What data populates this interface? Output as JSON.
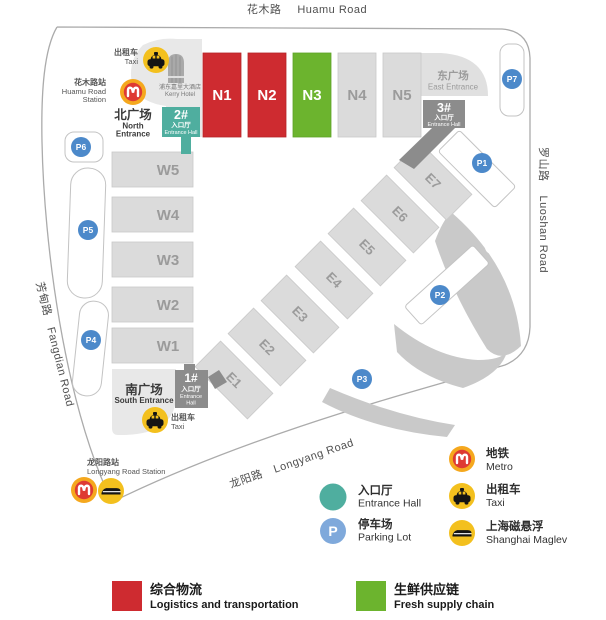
{
  "map": {
    "roads": {
      "huamu": {
        "cn": "花木路",
        "en": "Huamu Road"
      },
      "luoshan": {
        "cn": "罗山路",
        "en": "Luoshan Road"
      },
      "fangdian": {
        "cn": "芳甸路",
        "en": "Fangdian Road"
      },
      "longyang": {
        "cn": "龙阳路",
        "en": "Longyang Road"
      }
    },
    "stations": {
      "huamu": {
        "cn": "花木路站",
        "en1": "Huamu Road",
        "en2": "Station"
      },
      "longyang": {
        "cn": "龙阳路站",
        "en": "Longyang Road Station"
      }
    },
    "hotel": {
      "cn": "浦东嘉里大酒店",
      "en": "Kerry Hotel"
    },
    "plazas": {
      "north": {
        "cn": "北广场",
        "en1": "North",
        "en2": "Entrance"
      },
      "south": {
        "cn": "南广场",
        "en": "South Entrance"
      },
      "east": {
        "cn": "东广场",
        "en": "East Entrance"
      }
    },
    "gates": {
      "g1": {
        "no": "1#",
        "cn": "入口厅",
        "en1": "Entrance",
        "en2": "Hall"
      },
      "g2": {
        "no": "2#",
        "cn": "入口厅",
        "en": "Entrance Hall"
      },
      "g3": {
        "no": "3#",
        "cn": "入口厅",
        "en": "Entrance Hall"
      }
    },
    "halls": {
      "n1": "N1",
      "n2": "N2",
      "n3": "N3",
      "n4": "N4",
      "n5": "N5",
      "w1": "W1",
      "w2": "W2",
      "w3": "W3",
      "w4": "W4",
      "w5": "W5",
      "e1": "E1",
      "e2": "E2",
      "e3": "E3",
      "e4": "E4",
      "e5": "E5",
      "e6": "E6",
      "e7": "E7"
    },
    "parking": {
      "p1": "P1",
      "p2": "P2",
      "p3": "P3",
      "p4": "P4",
      "p5": "P5",
      "p6": "P6",
      "p7": "P7"
    },
    "taxi": {
      "cn": "出租车",
      "en": "Taxi"
    }
  },
  "legend": {
    "entrance_hall": {
      "cn": "入口厅",
      "en": "Entrance Hall"
    },
    "parking_lot": {
      "cn": "停车场",
      "en": "Parking Lot",
      "symbol": "P"
    },
    "metro": {
      "cn": "地铁",
      "en": "Metro"
    },
    "taxi": {
      "cn": "出租车",
      "en": "Taxi"
    },
    "maglev": {
      "cn": "上海磁悬浮",
      "en": "Shanghai Maglev"
    },
    "logistics": {
      "cn": "综合物流",
      "en": "Logistics and transportation"
    },
    "fresh": {
      "cn": "生鲜供应链",
      "en": "Fresh supply chain"
    }
  },
  "colors": {
    "logistics_red": "#CE2B30",
    "fresh_green": "#6CB42E",
    "entrance_teal": "#4FAE9F",
    "gate_gray": "#8C8C8C",
    "hall_gray": "#DBDBDB",
    "parking_blue": "#4C89CA",
    "legend_parking_blue": "#7FA9DB",
    "icon_yellow": "#F3C01E",
    "metro_orange": "#F5A81E",
    "metro_red": "#DE3A33"
  }
}
